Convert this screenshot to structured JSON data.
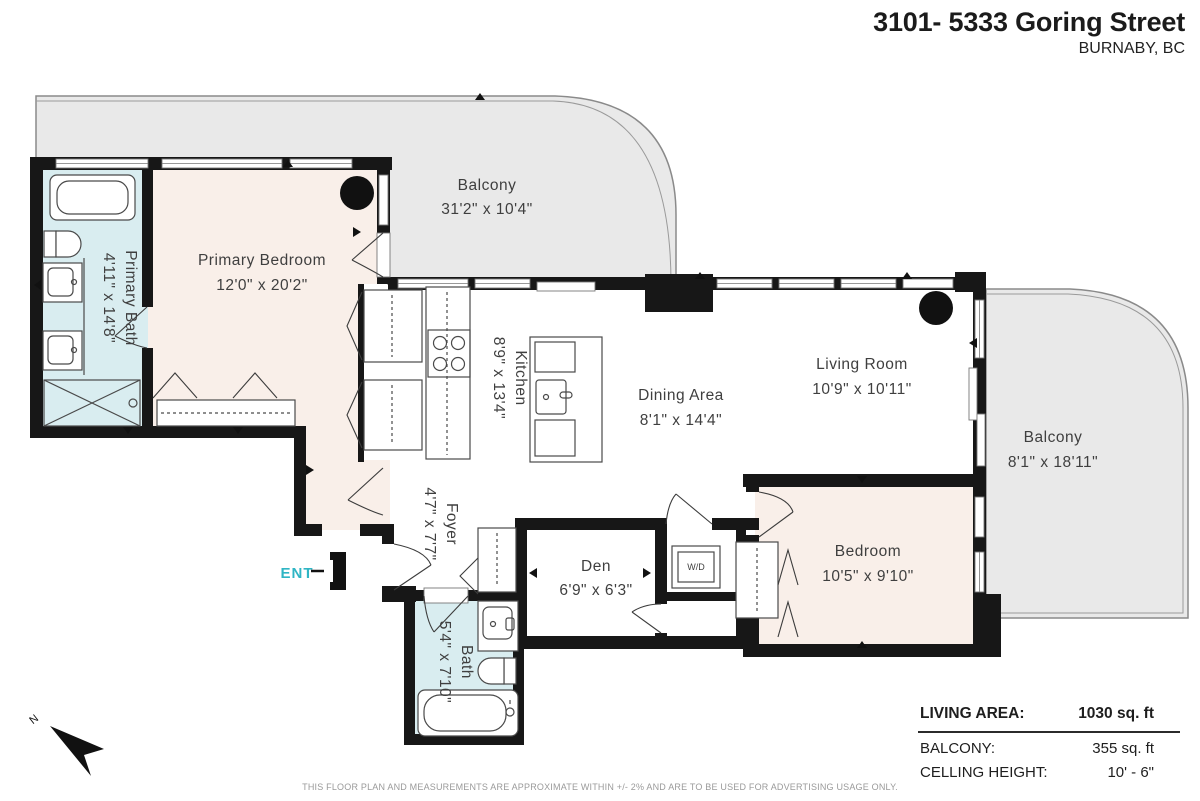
{
  "header": {
    "address": "3101- 5333 Goring Street",
    "city": "BURNABY, BC"
  },
  "rooms": {
    "balcony_top": {
      "name": "Balcony",
      "dims": "31'2\" x 10'4\""
    },
    "primary_bedroom": {
      "name": "Primary Bedroom",
      "dims": "12'0\" x 20'2\""
    },
    "primary_bath": {
      "name": "Primary Bath",
      "dims": "4'11\" x 14'8\""
    },
    "kitchen": {
      "name": "Kitchen",
      "dims": "8'9\" x 13'4\""
    },
    "dining": {
      "name": "Dining Area",
      "dims": "8'1\" x 14'4\""
    },
    "living": {
      "name": "Living Room",
      "dims": "10'9\" x 10'11\""
    },
    "balcony_right": {
      "name": "Balcony",
      "dims": "8'1\" x 18'11\""
    },
    "foyer": {
      "name": "Foyer",
      "dims": "4'7\" x 7'7\""
    },
    "den": {
      "name": "Den",
      "dims": "6'9\" x 6'3\""
    },
    "bedroom": {
      "name": "Bedroom",
      "dims": "10'5\" x 9'10\""
    },
    "bath": {
      "name": "Bath",
      "dims": "5'4\" x 7'10\""
    },
    "laundry": {
      "name": "W/D"
    }
  },
  "markers": {
    "entry": "ENT",
    "north": "N"
  },
  "legend": {
    "rows": [
      {
        "label": "LIVING AREA:",
        "value": "1030 sq. ft"
      },
      {
        "label": "BALCONY:",
        "value": "355 sq. ft"
      },
      {
        "label": "CELLING HEIGHT:",
        "value": "10' - 6\""
      }
    ]
  },
  "disclaimer": "THIS FLOOR PLAN AND MEASUREMENTS ARE APPROXIMATE WITHIN +/- 2% AND ARE TO BE USED FOR ADVERTISING USAGE ONLY.",
  "colors": {
    "wall": "#171717",
    "balcony_fill": "#e9e9e9",
    "bedroom_fill": "#f9efe9",
    "bath_fill": "#d9edf0",
    "accent": "#2fb5c4"
  }
}
